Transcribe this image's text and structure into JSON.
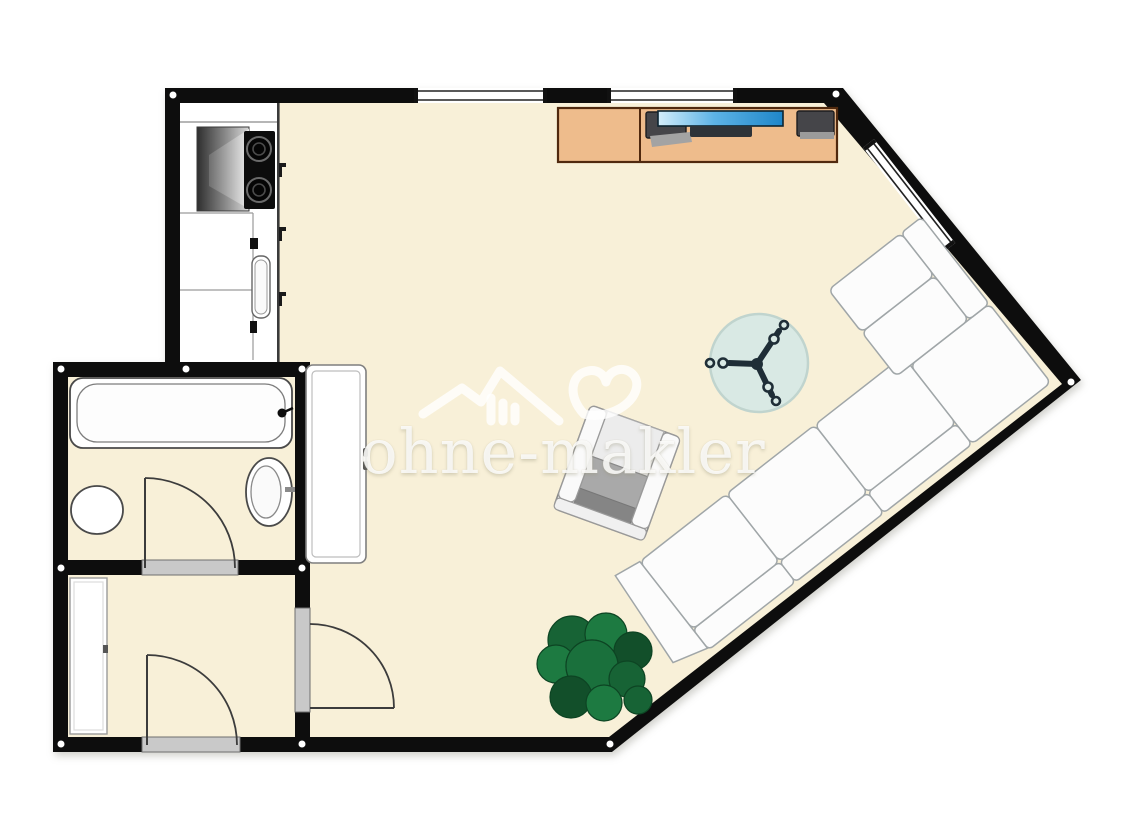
{
  "meta": {
    "type": "floor-plan",
    "view": "2d-top-down",
    "domain": "real-estate-floorplan"
  },
  "watermark": {
    "text": "ohne-makler",
    "logo": "house-heart-logo",
    "color": "#ffffff",
    "opacity": 0.8
  },
  "palette": {
    "background": "#ffffff",
    "wall": "#0d0d0d",
    "floor_cream": "#f8f0d8",
    "kitchen_floor": "#ffffff",
    "fixture_outline": "#555555",
    "door_sill": "#c9c9c9",
    "desk_wood": "#eebc8c",
    "desk_outline": "#50290e",
    "screen_blue": "#2a8fd4",
    "monitor_dark": "#454549",
    "fan_disc": "#d9e9e4",
    "sofa_white": "#fcfcfc",
    "sofa_outline": "#a0a6a8",
    "chair_seat_gray": "#a9a9a9",
    "plant_green": "#1d7a41",
    "plant_green_dark": "#124f2a"
  },
  "rooms": [
    {
      "name": "living-room",
      "floor": "#f8f0d8",
      "furniture": [
        "desk",
        "monitor-left",
        "tv-screen",
        "monitor-right",
        "ceiling-fan",
        "armchair",
        "corner-sofa",
        "plant",
        "wardrobe"
      ]
    },
    {
      "name": "kitchen",
      "floor": "#ffffff",
      "furniture": [
        "counter",
        "range-hood",
        "cooktop",
        "sink"
      ]
    },
    {
      "name": "bathroom",
      "floor": "#f8f0d8",
      "furniture": [
        "bathtub",
        "toilet",
        "washbasin"
      ]
    },
    {
      "name": "hallway",
      "floor": "#f8f0d8",
      "furniture": [
        "closet"
      ]
    }
  ],
  "openings": {
    "windows": [
      "top-wall-window-left",
      "top-wall-window-right",
      "angled-wall-window"
    ],
    "doors": [
      "bathroom-door",
      "hallway-entry-door",
      "living-room-door"
    ]
  }
}
